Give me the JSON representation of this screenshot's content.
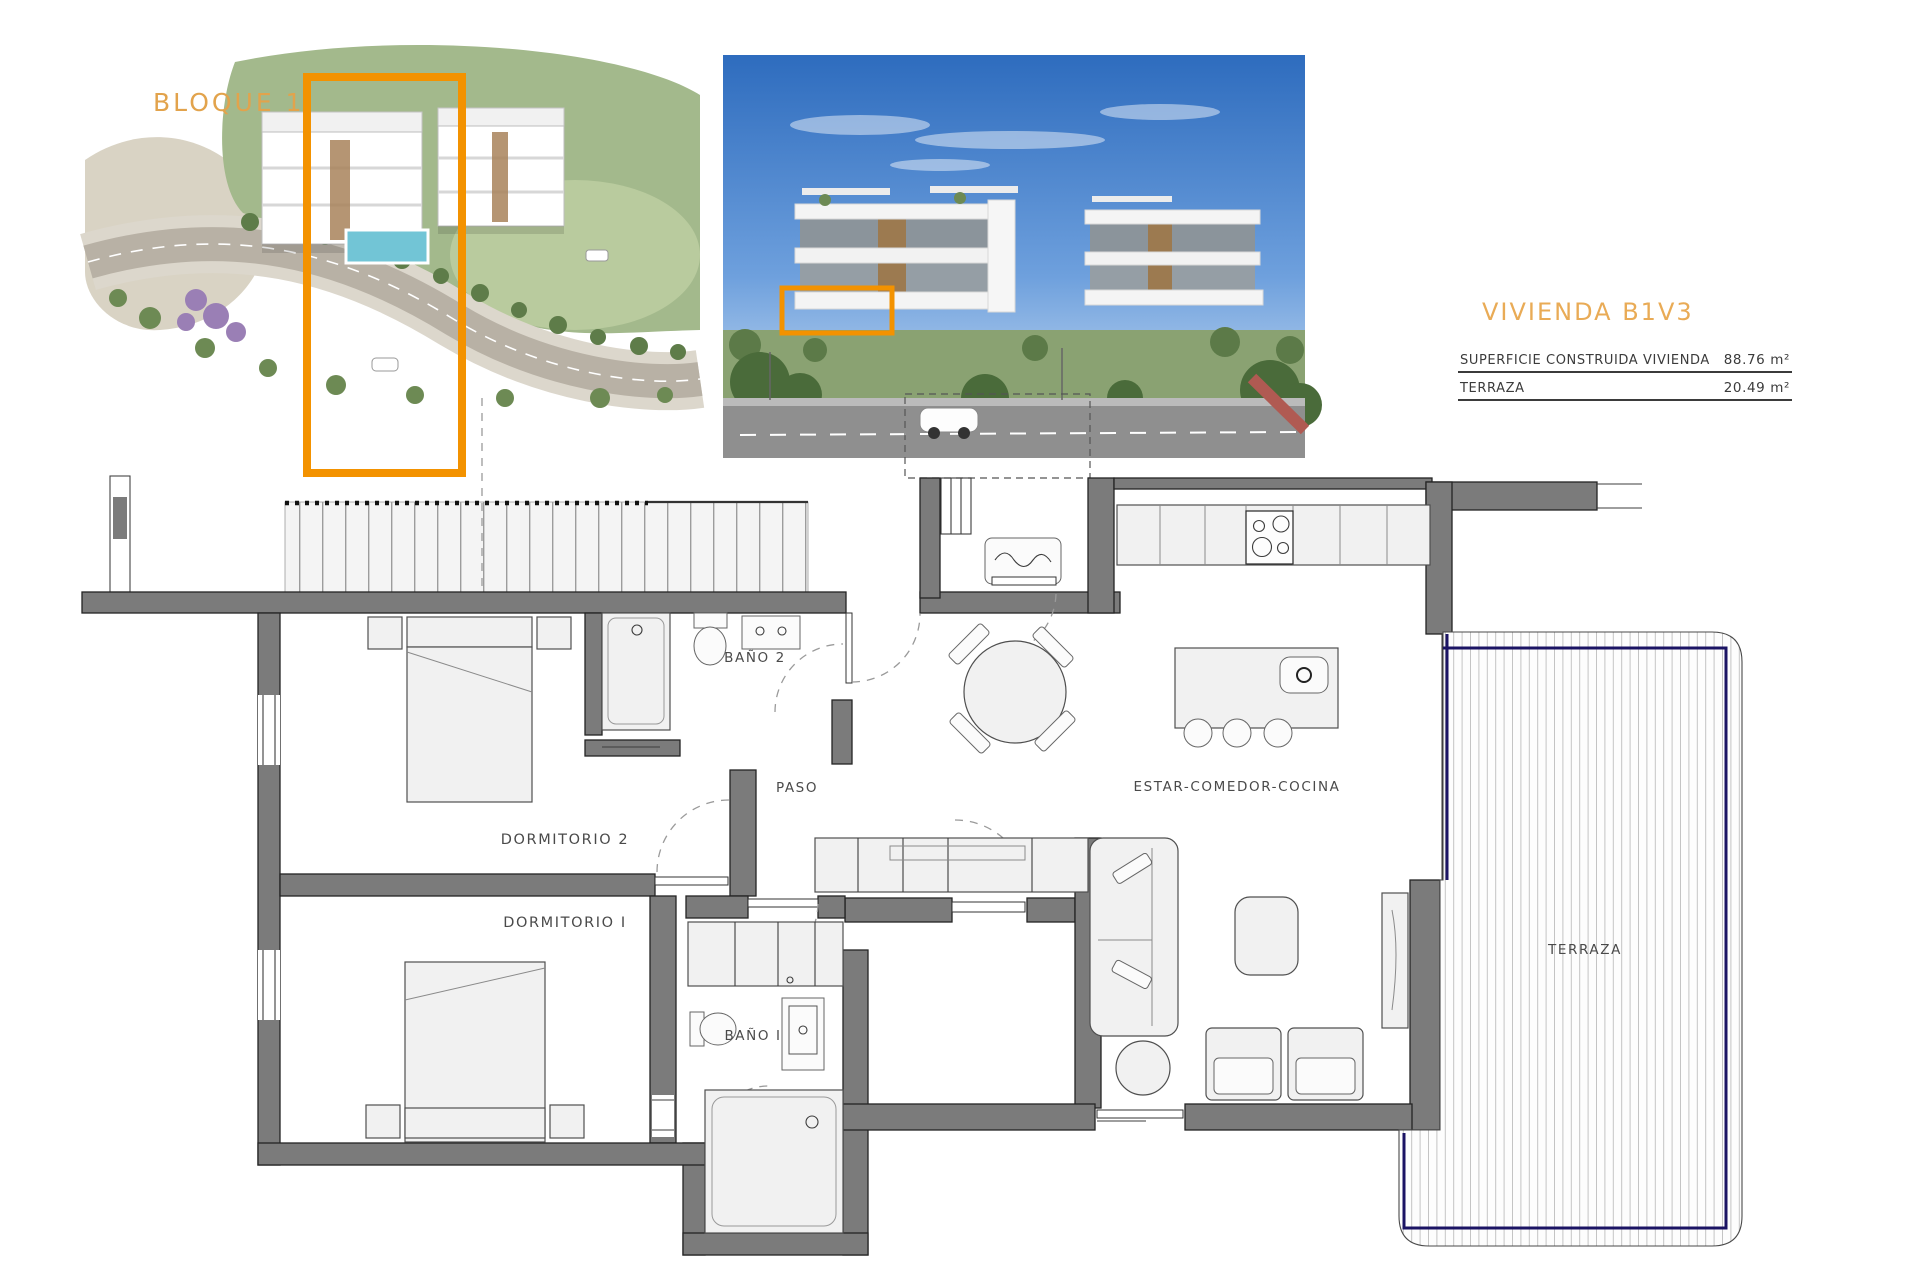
{
  "header": {
    "bloque_label": "BLOQUE 1",
    "title": "VIVIENDA B1V3",
    "area_table": {
      "rows": [
        {
          "label": "SUPERFICIE CONSTRUIDA VIVIENDA",
          "value": "88.76 m²"
        },
        {
          "label": "TERRAZA",
          "value": "20.49 m²"
        }
      ]
    }
  },
  "plan": {
    "rooms": {
      "bano2": "BAÑO 2",
      "paso": "PASO",
      "dormitorio2": "DORMITORIO 2",
      "dormitorio1": "DORMITORIO I",
      "bano1": "BAÑO I",
      "estar": "ESTAR-COMEDOR-COCINA",
      "terraza": "TERRAZA"
    }
  },
  "colors": {
    "highlight_orange": "#F39200",
    "heading_orange": "#E9AB56",
    "wall_gray": "#7B7B7B",
    "terrace_navy": "#1B1464"
  }
}
